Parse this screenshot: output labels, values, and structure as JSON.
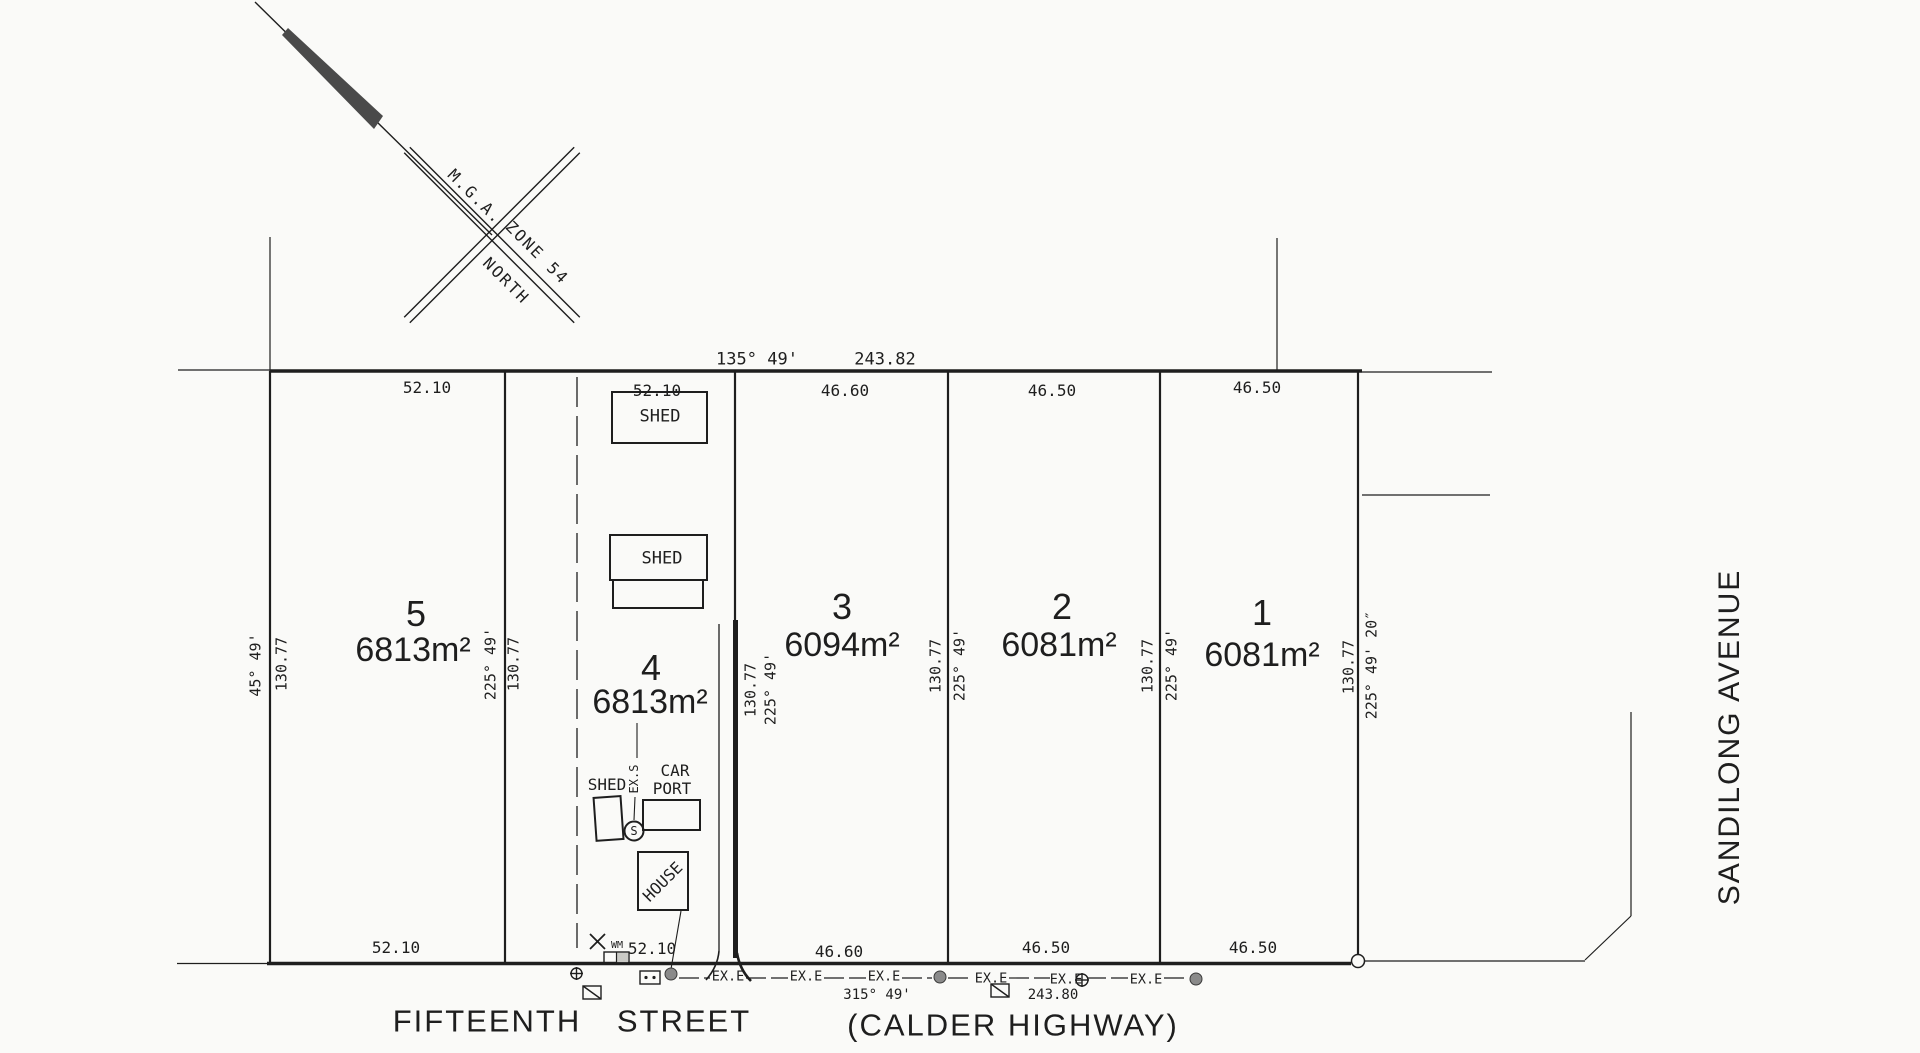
{
  "colors": {
    "ink": "#1e1e1e",
    "paper": "#fafaf8",
    "pole_fill": "#8a8a8a",
    "needle_fill": "#4a4a4a",
    "shade_fill": "#c9c9c5"
  },
  "compass": {
    "mga": "M.G.A.",
    "zone": "ZONE 54",
    "north": "NORTH"
  },
  "north_boundary": {
    "bearing": "135° 49'",
    "distance": "243.82"
  },
  "south_boundary": {
    "bearing": "315° 49'",
    "distance": "243.80"
  },
  "lots": [
    {
      "number": "5",
      "area": "6813m²",
      "frontage_top": "52.10",
      "frontage_bottom": "52.10"
    },
    {
      "number": "4",
      "area": "6813m²",
      "frontage_top": "52.10",
      "frontage_bottom": "52.10"
    },
    {
      "number": "3",
      "area": "6094m²",
      "frontage_top": "46.60",
      "frontage_bottom": "46.60"
    },
    {
      "number": "2",
      "area": "6081m²",
      "frontage_top": "46.50",
      "frontage_bottom": "46.50"
    },
    {
      "number": "1",
      "area": "6081m²",
      "frontage_top": "46.50",
      "frontage_bottom": "46.50"
    }
  ],
  "boundaries": {
    "west": {
      "bearing": "45° 49'",
      "distance": "130.77"
    },
    "lot5_lot4": {
      "bearing": "225° 49'",
      "distance": "130.77"
    },
    "lot4_lot3": {
      "bearing": "225° 49'",
      "distance": "130.77"
    },
    "lot3_lot2": {
      "bearing": "225° 49'",
      "distance": "130.77"
    },
    "lot2_lot1": {
      "bearing": "225° 49'",
      "distance": "130.77"
    },
    "east": {
      "bearing": "225° 49' 20″",
      "distance": "130.77"
    }
  },
  "streets": {
    "fifteenth": "FIFTEENTH",
    "street": "STREET",
    "calder": "(CALDER HIGHWAY)",
    "sandilong": "SANDILONG AVENUE"
  },
  "annotations": {
    "exe": "EX.E",
    "exs": "EX.S",
    "wm": "WM",
    "s": "S"
  },
  "structures": {
    "shed_top": "SHED",
    "shed_middle": "SHED",
    "shed_small": "SHED",
    "car": "CAR",
    "port": "PORT",
    "house": "HOUSE"
  }
}
